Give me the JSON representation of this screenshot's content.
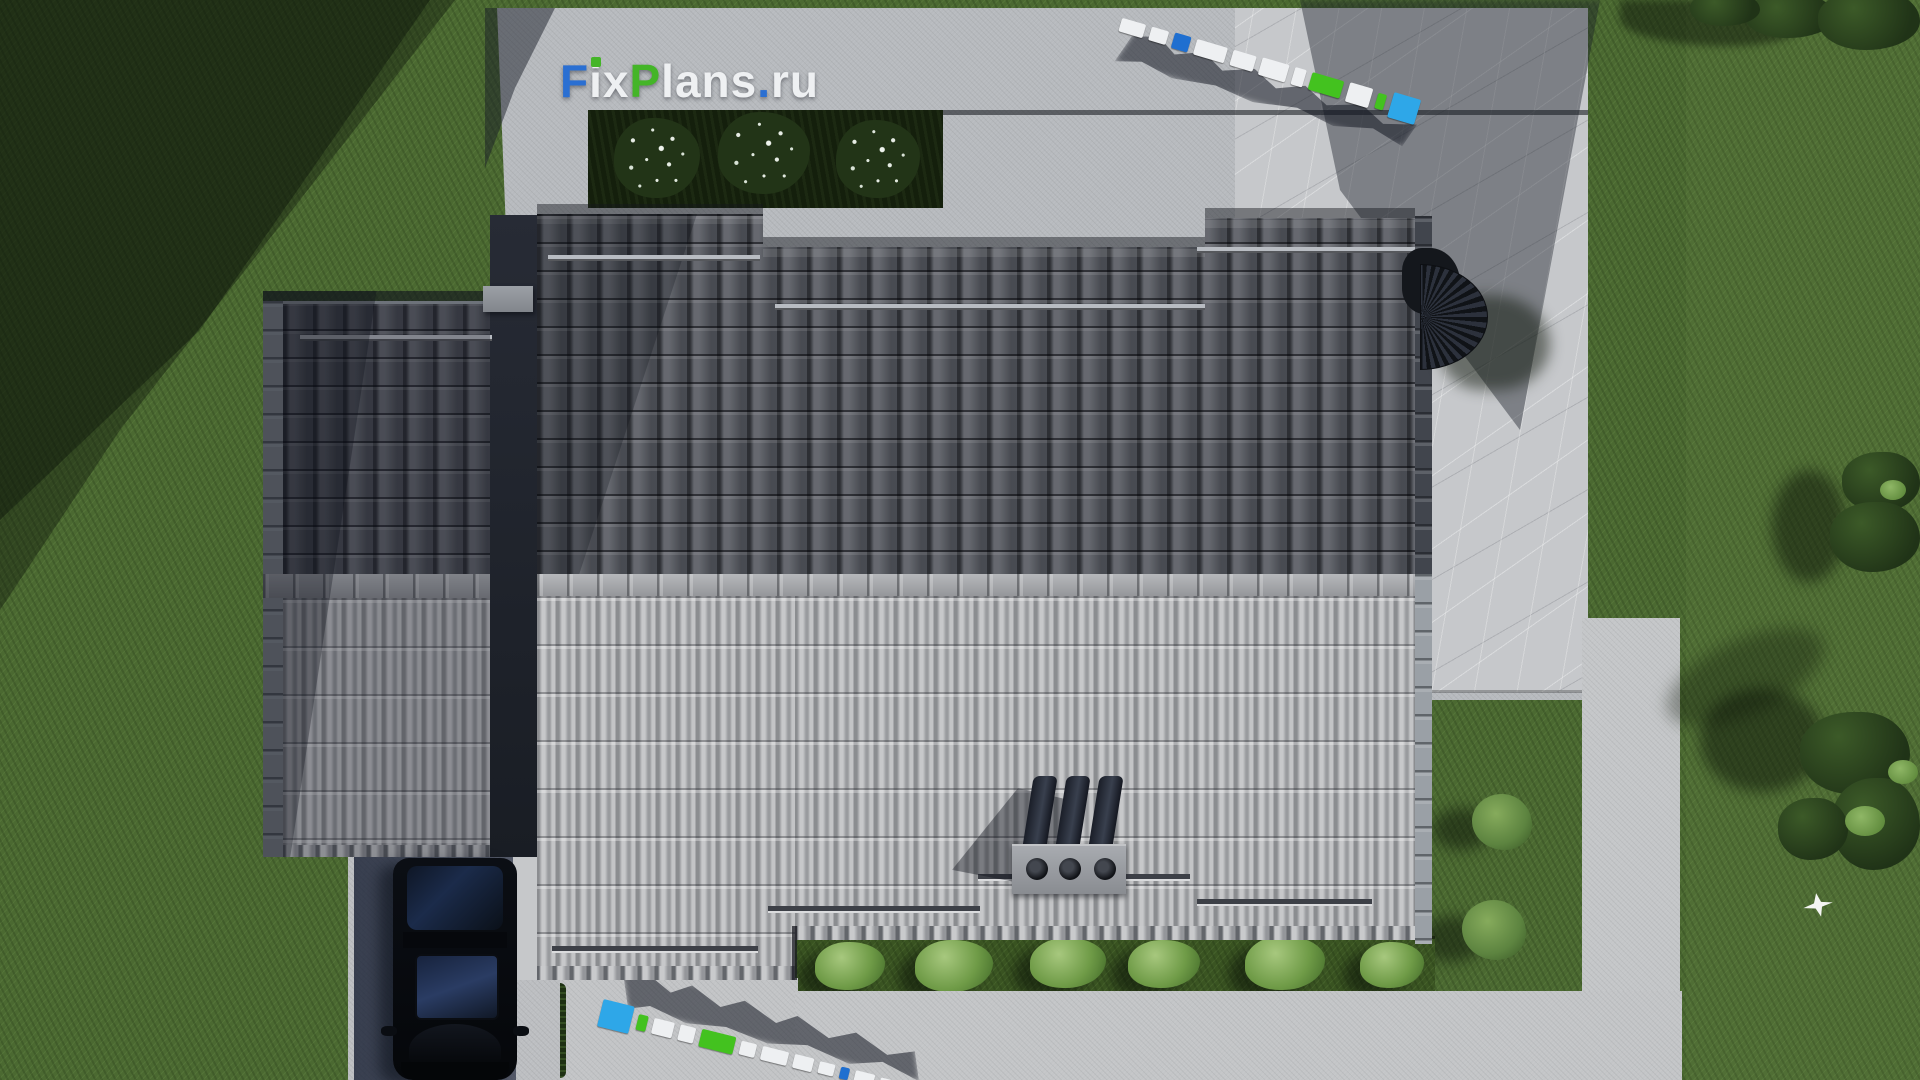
{
  "watermark": {
    "text": "FixPlans.ru",
    "parts": [
      {
        "text": "F",
        "color": "#2a6fd2"
      },
      {
        "text": "i",
        "color": "#eef0f2"
      },
      {
        "text": "x",
        "color": "#eef0f2"
      },
      {
        "text": "P",
        "color": "#44b528"
      },
      {
        "text": "lans",
        "color": "#eef0f2"
      },
      {
        "text": ".",
        "color": "#2a6fd2"
      },
      {
        "text": "ru",
        "color": "#eef0f2"
      }
    ],
    "i_dot_color": "#44b528"
  },
  "watermark_3d": {
    "white": "#eef0f2",
    "blue": "#2ea7e8",
    "blue_dark": "#1f6fd0",
    "green": "#43c21f"
  },
  "palette": {
    "grass": "#4b6931",
    "grass_shadow": "#22351a",
    "concrete": "#b7babe",
    "marble": "#c6c8cb",
    "roof_dark_tiles": "#5a5d64",
    "roof_light_ribs": "#aeafb2",
    "ridge": "#a6a8ac",
    "planter": "#141f0c",
    "shrub": "#7ca557",
    "car_body": "#0a0c10",
    "driveway_shadow": "#232f48"
  }
}
